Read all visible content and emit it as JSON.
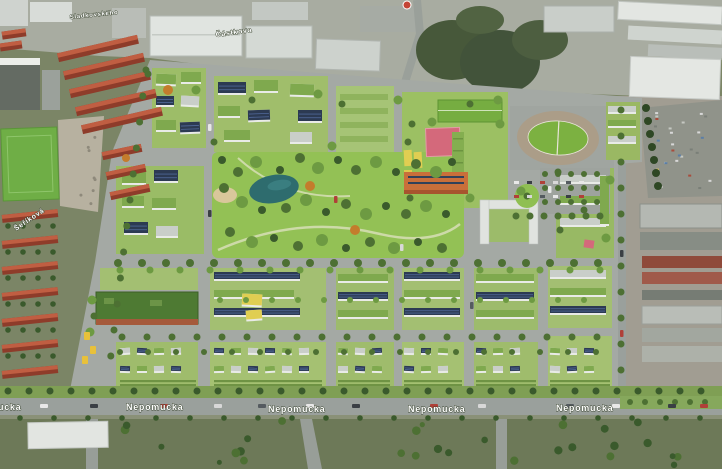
{
  "map": {
    "road_labels": {
      "nepomucka": "Nepomucka",
      "castkova": "Částkova",
      "sladkovskeho": "Sladkovského",
      "serikova": "Šeříková"
    }
  },
  "colors": {
    "park_green": "#93c155",
    "pond_teal": "#2e6c6e",
    "court_pink": "#d4697b",
    "court_yellow": "#e0ce52",
    "track_tan": "#ab9d88",
    "pitch_green": "#7cb141",
    "school_field_green": "#76ad41",
    "green_roof": "#7fa94e",
    "solar_roof": "#2c3a52",
    "supermarket_roof": "#4e7a33",
    "red_roof": "#b5543c",
    "road_gray": "#9aa09c"
  }
}
